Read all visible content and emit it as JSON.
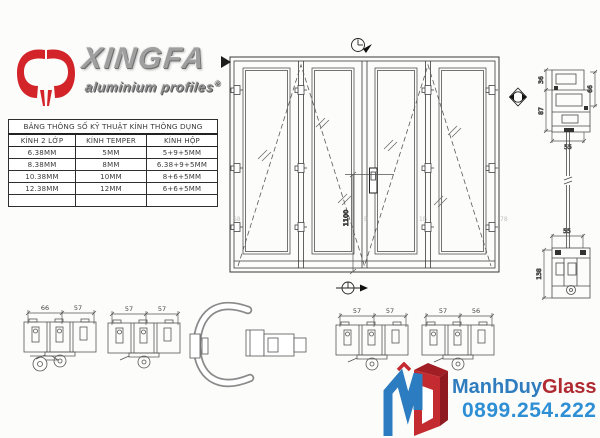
{
  "brand": {
    "name": "XINGFA",
    "tagline": "aluminium profiles",
    "registered_mark": "®",
    "logo_red": "#d3242a"
  },
  "spec_table": {
    "title": "BẢNG THÔNG SỐ KỸ THUẬT KÍNH THÔNG DỤNG",
    "columns": [
      "KÍNH 2 LỚP",
      "KÍNH TEMPER",
      "KÍNH HỘP"
    ],
    "rows": [
      [
        "6.38MM",
        "5MM",
        "5+9+5MM"
      ],
      [
        "8.38MM",
        "8MM",
        "6.38+9+5MM"
      ],
      [
        "10.38MM",
        "10MM",
        "8+6+5MM"
      ],
      [
        "12.38MM",
        "12MM",
        "6+6+5MM"
      ]
    ]
  },
  "elevation": {
    "panels": 4,
    "handle_height_dim": "1100",
    "faint_marks": [
      "S8",
      "B",
      "1B",
      "78"
    ]
  },
  "sections": {
    "head": {
      "dim_36": "36",
      "dim_87": "87",
      "dim_66": "66",
      "dim_55": "55"
    },
    "sill": {
      "dim_55": "55",
      "dim_138": "138"
    },
    "plan_groups": [
      {
        "dim_a": "66",
        "dim_b": "57"
      },
      {
        "dim_a": "57",
        "dim_b": "57"
      },
      {
        "dim_a": "57",
        "dim_b": "57"
      },
      {
        "dim_a": "57",
        "dim_b": "56"
      }
    ]
  },
  "footer": {
    "brand_part1": "ManhDuy",
    "brand_part2": "Glass",
    "phone": "0899.254.222",
    "blue": "#2f7dbf",
    "red": "#b02a31",
    "phone_blue": "#2e8fd5"
  }
}
